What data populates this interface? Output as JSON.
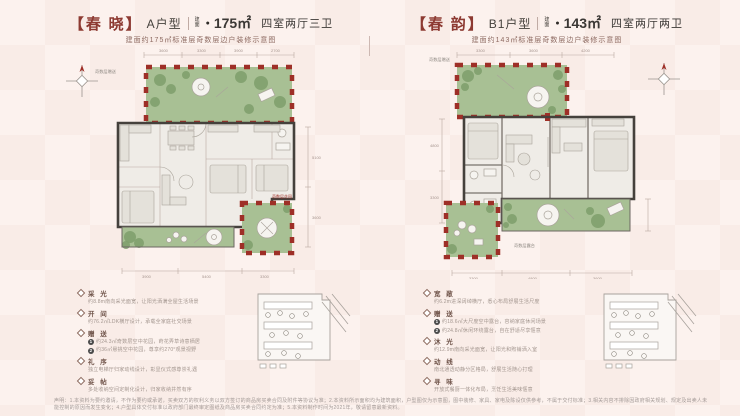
{
  "panels": [
    {
      "name": "【春 晓】",
      "type": "A户型",
      "area_label": "建面",
      "dot": "●",
      "area": "175㎡",
      "rooms": "四室两厅三卫",
      "subtitle": "建面约175㎡标准层奇数层边户装修示意图",
      "plan": {
        "gift_label": "奇数层赠送",
        "terrace_label": "奇数层花园",
        "dims_top": [
          "3600",
          "3300",
          "3900",
          "2700"
        ],
        "dims_bottom": [
          "3900",
          "5400",
          "3300"
        ],
        "dims_side": [
          "5100",
          "3600"
        ]
      },
      "features": [
        {
          "title": "采 光",
          "lines": [
            {
              "badge": "",
              "text": "约8.8m南向采光面宽，让阳光洒满全屋生活场景"
            }
          ]
        },
        {
          "title": "开 间",
          "lines": [
            {
              "badge": "",
              "text": "约76.2㎡LDK横厅设计，承载全家庭社交场景"
            }
          ]
        },
        {
          "title": "赠 送",
          "lines": [
            {
              "badge": "1",
              "text": "约24.3㎡奇数层空中花园，莳花弄草诗意栖居"
            },
            {
              "badge": "2",
              "text": "约36㎡悬挑空中花园，尊享约270°观景视野"
            }
          ]
        },
        {
          "title": "礼 序",
          "lines": [
            {
              "badge": "",
              "text": "独立电梯厅归家动线设计，彰显仪式感尊崇礼遇"
            }
          ]
        },
        {
          "title": "妥 帖",
          "lines": [
            {
              "badge": "",
              "text": "多处收纳空间定制化设计，归家收纳井然有序"
            }
          ]
        }
      ]
    },
    {
      "name": "【春 韵】",
      "type": "B1户型",
      "area_label": "建面",
      "dot": "●",
      "area": "143㎡",
      "rooms": "四室两厅两卫",
      "subtitle": "建面约143㎡标准层奇数层边户装修示意图",
      "plan": {
        "gift_label": "奇数层赠送",
        "terrace_label": "奇数层露台",
        "dims_top": [
          "3300",
          "3600",
          "4200"
        ],
        "dims_bottom": [
          "3300",
          "4800",
          "3600"
        ],
        "dims_side": [
          "4800",
          "3300"
        ]
      },
      "features": [
        {
          "title": "宽 敞",
          "lines": [
            {
              "badge": "",
              "text": "约6.2m进深阔绰横厅，悉心布局舒展生活尺度"
            }
          ]
        },
        {
          "title": "赠 送",
          "lines": [
            {
              "badge": "1",
              "text": "约18.6㎡大尺度空中露台，容纳家庭休闲场景"
            },
            {
              "badge": "2",
              "text": "约24.8㎡休闲环绕露台，自在舒适尽享惬意"
            }
          ]
        },
        {
          "title": "沐 光",
          "lines": [
            {
              "badge": "",
              "text": "约12.9m南向采光面宽，让阳光和煦铺洒入室"
            }
          ]
        },
        {
          "title": "动 线",
          "lines": [
            {
              "badge": "",
              "text": "南北通透动静分区格局，舒展生活随心打理"
            }
          ]
        },
        {
          "title": "寻 味",
          "lines": [
            {
              "badge": "",
              "text": "开放式餐厨一体化布局，烹饪生活美味惬意"
            }
          ]
        }
      ]
    }
  ],
  "disclaimer": "声明：1.本资料为要约邀请，不作为要约或承诺，买卖双方的权利义务以双方签订的商品房买卖合同及附件等协议为准；2.本资料所示面积均为建筑面积，户型图仅为示意图，图中装修、家具、家电及陈设仅供参考，不属于交付标准；3.相关内容不排除因政府相关规划、规定及出卖人未能控制的原因而发生变化；4.户型具体交付标准以政府部门最终审定图纸及商品房买卖合同约定为准；5.本资料制作时间为2021年，敬请留意最新资料。"
}
